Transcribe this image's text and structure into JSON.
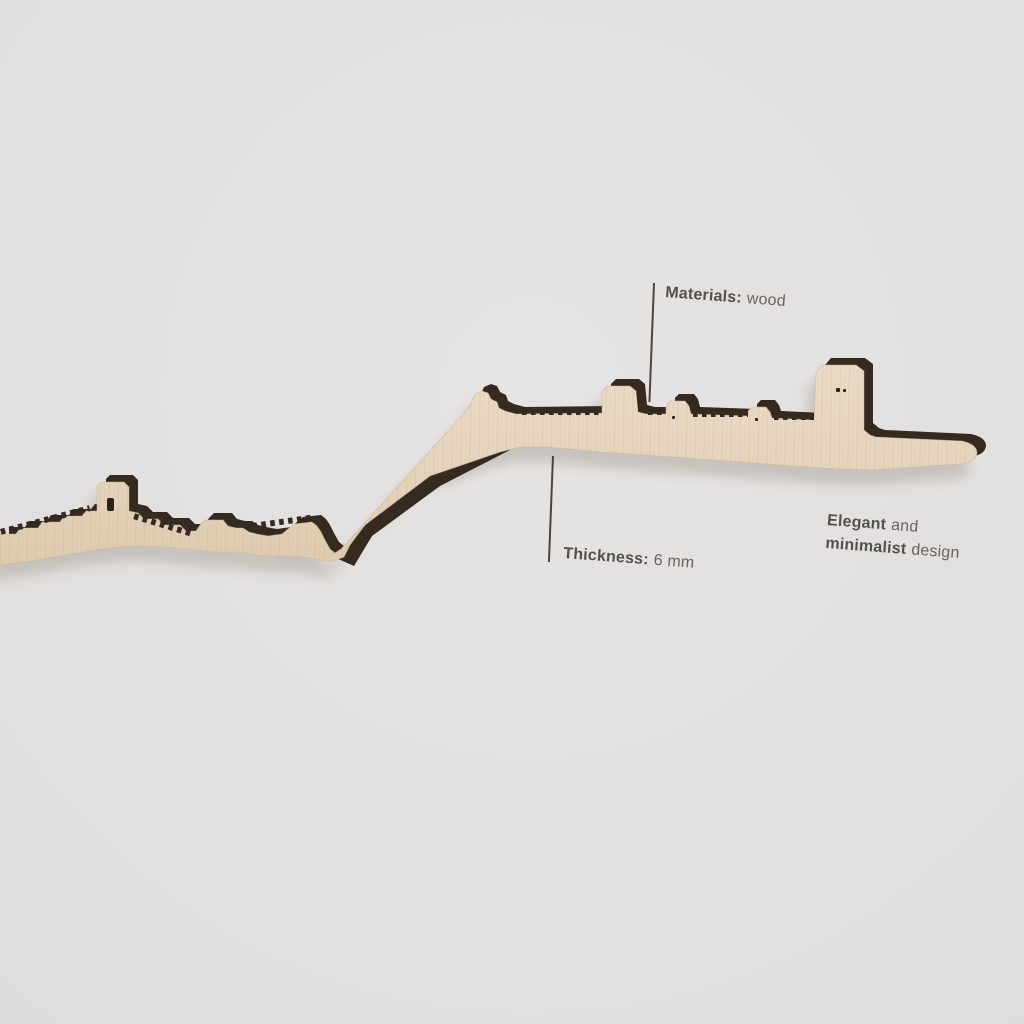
{
  "product": {
    "description": "Wooden skyline silhouette wall decor",
    "wood_color": "#e6d5bf",
    "edge_color": "#342a20",
    "background_color": "#e1dfdd"
  },
  "annotations": {
    "text_color": "#5d564f",
    "materials": {
      "label": "Materials:",
      "value": "wood"
    },
    "thickness": {
      "label": "Thickness:",
      "value": "6 mm"
    },
    "tagline_line1": {
      "bold": "Elegant",
      "rest": "and"
    },
    "tagline_line2": {
      "bold": "minimalist",
      "rest": "design"
    }
  }
}
